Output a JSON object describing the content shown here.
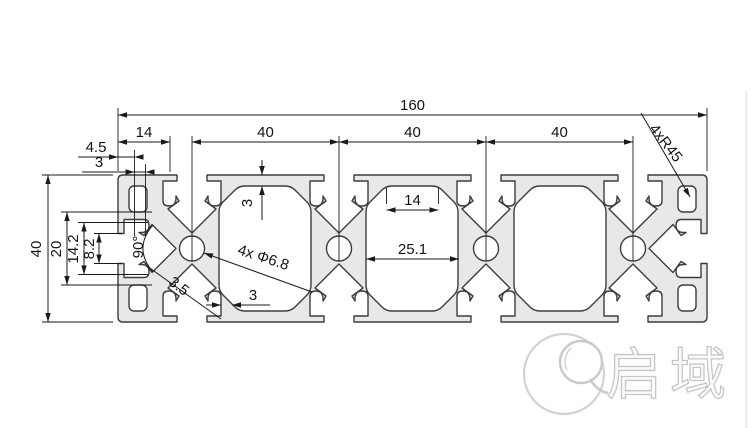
{
  "dims": {
    "overall_width": "160",
    "edge_to_first_slot": "14",
    "slot_pitch_1": "40",
    "slot_pitch_2": "40",
    "slot_pitch_3": "40",
    "corner_callout": "4xR45",
    "end_lip_depth": "4.5",
    "end_lip_step": "3",
    "overall_height": "40",
    "end_mid_span": "20",
    "end_slot_inner": "14.2",
    "end_slot_opening": "8.2",
    "vee_angle": "90°",
    "diag_wall": "3.5",
    "hole_callout": "4x Φ6.8",
    "top_wall": "3",
    "cavity_top_width": "14",
    "cavity_mid_width": "25.1",
    "bottom_wall": "3"
  },
  "logo": {
    "brand_name": "启域"
  },
  "colors": {
    "profile_fill": "#e8e8e8",
    "profile_stroke": "#3d3d3d",
    "dim_stroke": "#1a1a1a",
    "watermark": "#c9c9c9"
  }
}
